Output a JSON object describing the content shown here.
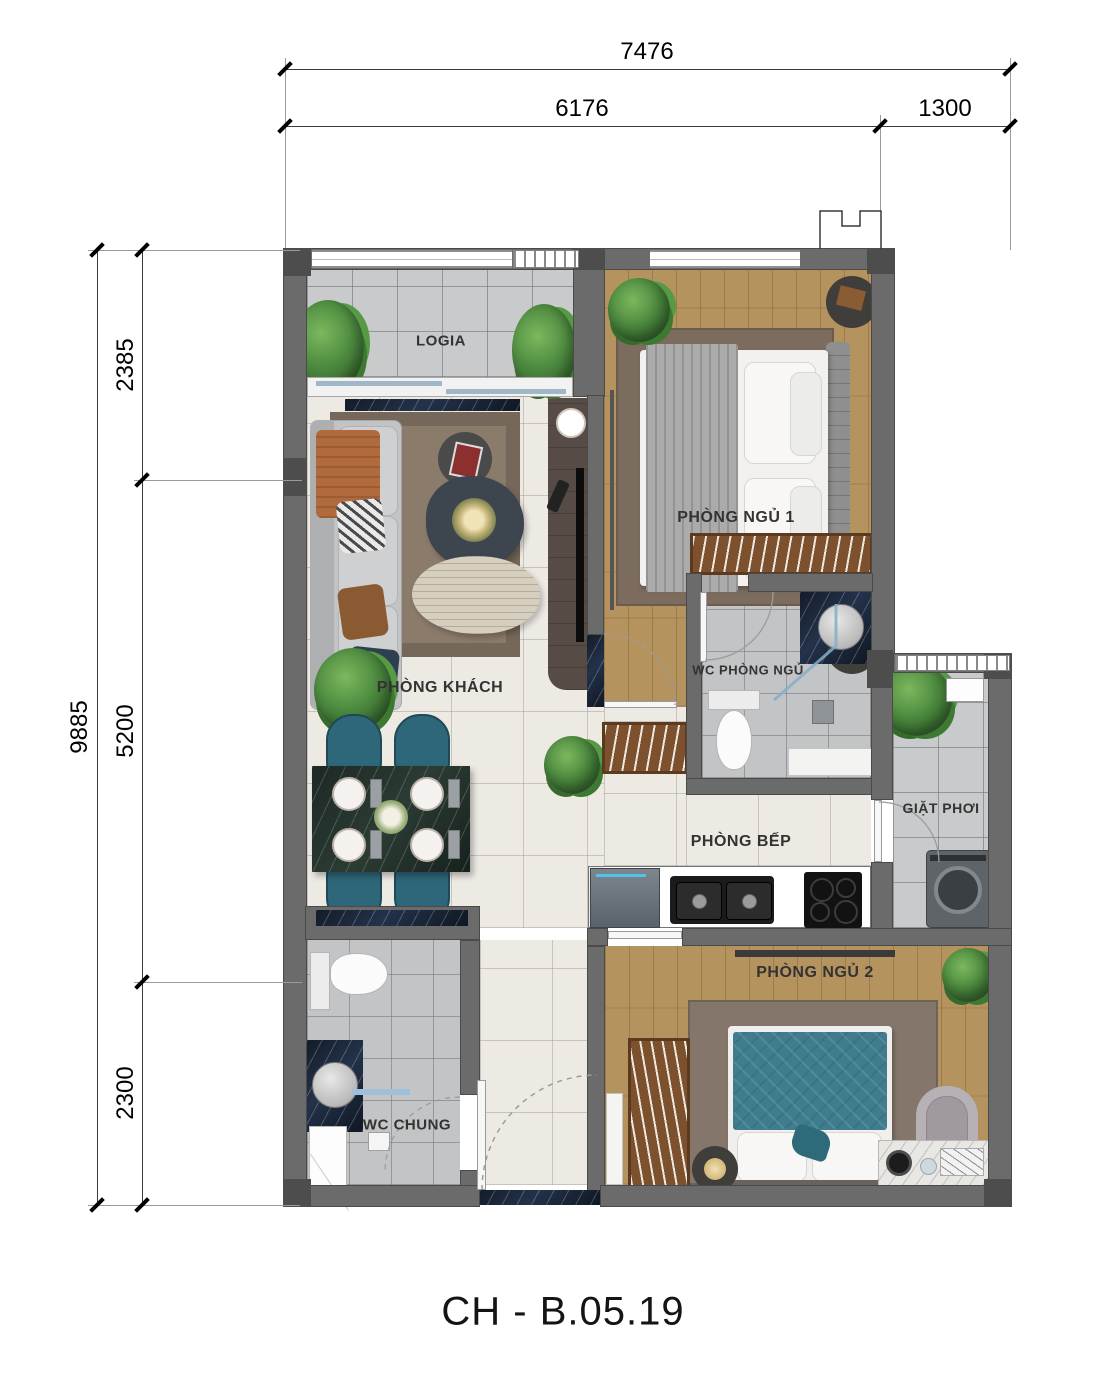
{
  "title": "CH - B.05.19",
  "dimensions": {
    "top_total": "7476",
    "top_seg1": "6176",
    "top_seg2": "1300",
    "left_total": "9885",
    "left_seg1": "2385",
    "left_seg2": "5200",
    "left_seg3": "2300"
  },
  "rooms": {
    "logia": "LOGIA",
    "living_room": "PHÒNG KHÁCH",
    "bedroom1": "PHÒNG NGỦ 1",
    "wc_bedroom": "WC PHÒNG NGỦ",
    "laundry": "GIẶT PHƠI",
    "kitchen": "PHÒNG BẾP",
    "bedroom2": "PHÒNG NGỦ 2",
    "wc_common": "WC CHUNG"
  },
  "colors": {
    "wall_gray": "#6b6b6b",
    "wall_dark": "#4d4d4d",
    "wood_floor": "#b5935f",
    "tile_cream": "#edeae4",
    "tile_gray": "#c8cacb",
    "chair_teal": "#2e6779",
    "bed2_teal": "#3f7d8e",
    "marble_green": "#1f2b27",
    "plant_green": "#4c8a3f"
  }
}
